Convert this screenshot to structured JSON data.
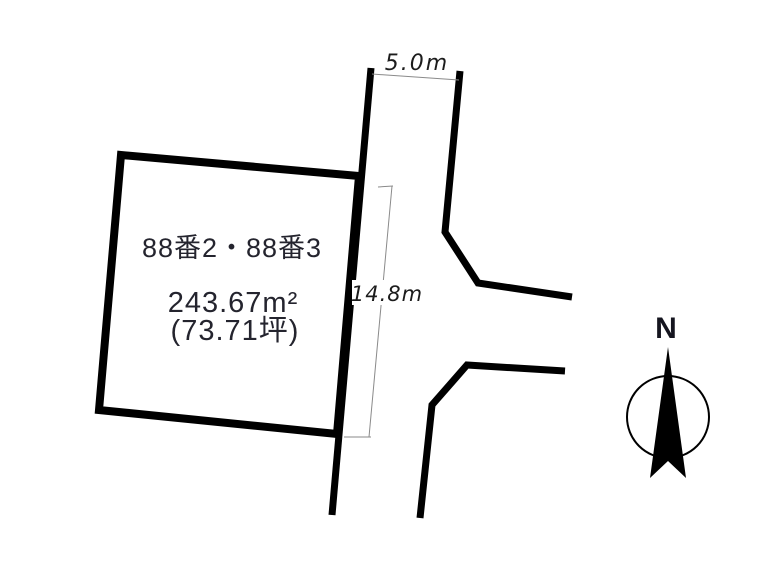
{
  "parcel": {
    "lot_label": "88番2・88番3",
    "area_sqm": "243.67m²",
    "area_tsubo": "(73.71坪)"
  },
  "dimensions": {
    "road_width_label": "5.0m",
    "side_length_label": "14.8m"
  },
  "compass": {
    "north_label": "N"
  },
  "colors": {
    "background": "#ffffff",
    "outline": "#000000",
    "dimension_line": "#8a8a8a",
    "parcel_text": "#24242e",
    "dimension_text": "#1c1c1c"
  }
}
